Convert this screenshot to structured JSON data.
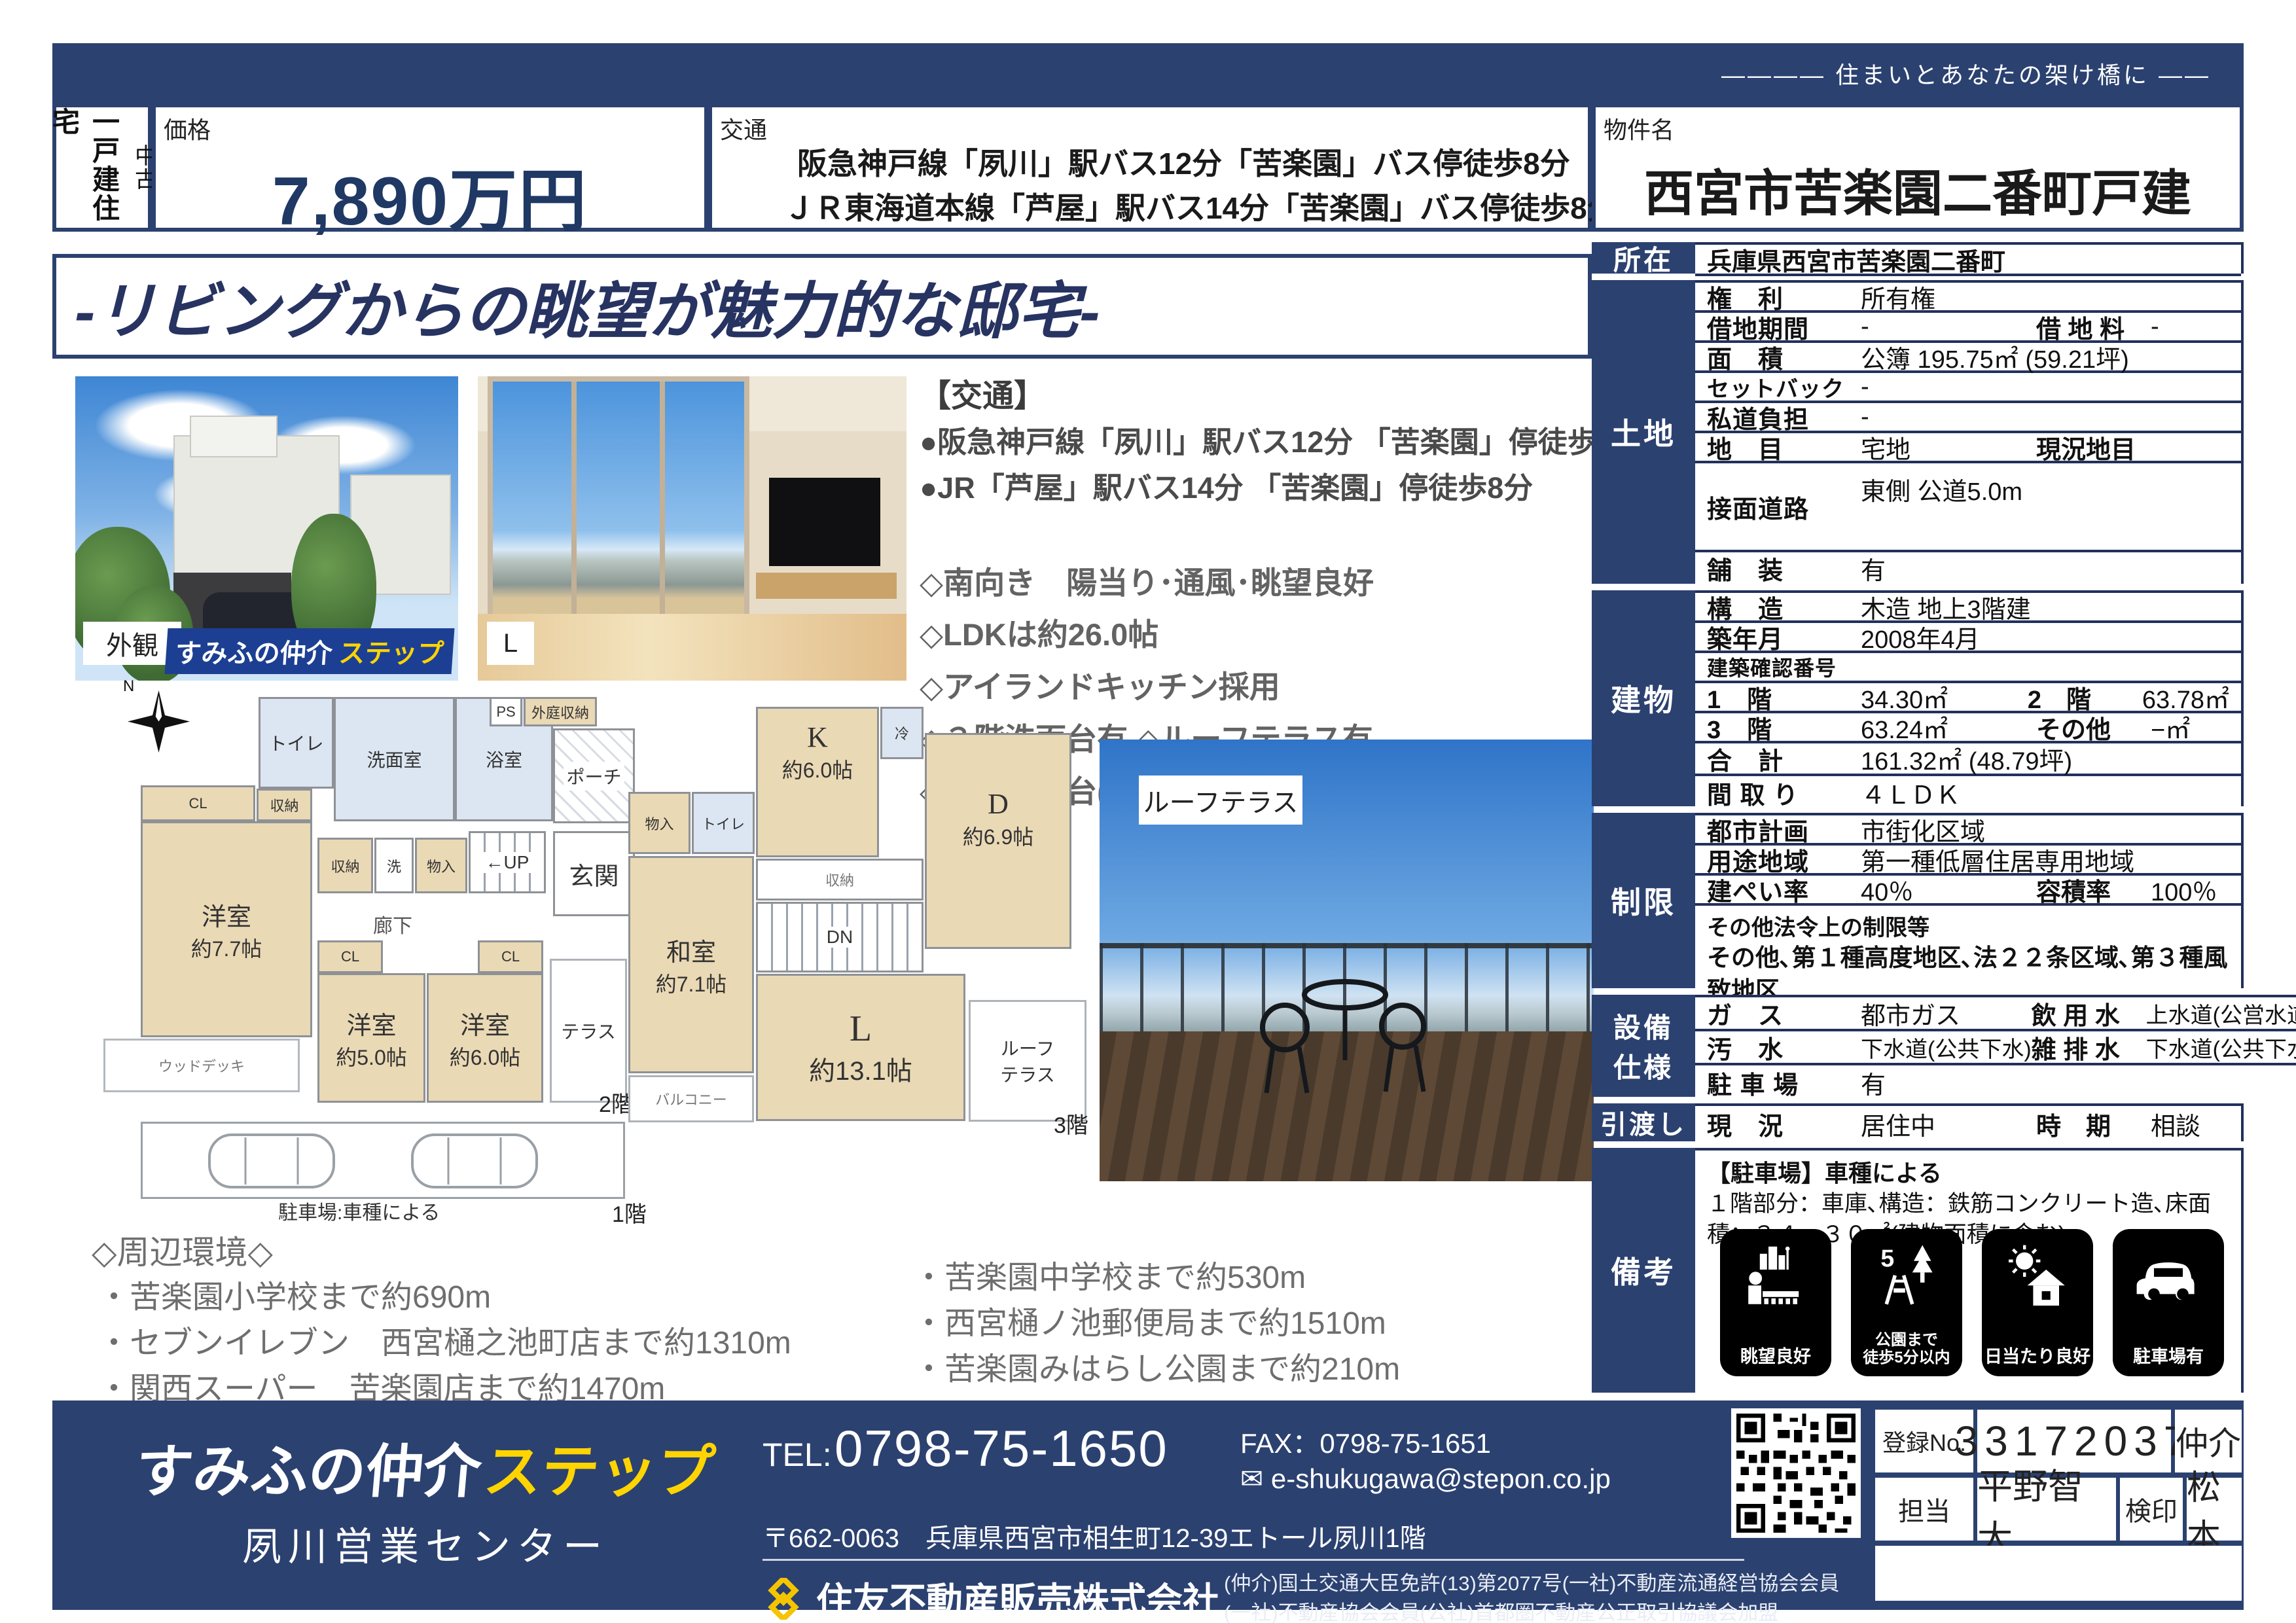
{
  "colors": {
    "navy": "#2b4170",
    "price_navy": "#1f3864",
    "yellow": "#ffd400",
    "beige": "#ead9b5",
    "wet": "#dce6f2"
  },
  "tagline": "―――― 住まいとあなたの架け橋に ――",
  "header": {
    "category_main": "一戸建住宅",
    "category_sub": "中古",
    "price_label": "価格",
    "price_value": "7,890万円",
    "access_label": "交通",
    "access_line1": "阪急神戸線「夙川」駅バス12分「苦楽園」バス停徒歩8分",
    "access_line2": "ＪＲ東海道本線「芦屋」駅バス14分「苦楽園」バス停徒歩8分",
    "property_label": "物件名",
    "property_name": "西宮市苦楽園二番町戸建"
  },
  "headline": "-リビングからの眺望が魅力的な邸宅-",
  "photos": {
    "exterior_caption": "外観",
    "brand_white": "すみふの仲介",
    "brand_yellow": "ステップ",
    "living_caption": "L",
    "roof_caption": "ルーフテラス"
  },
  "features": {
    "title": "【交通】",
    "item1": "●阪急神戸線「夙川」駅バス12分 「苦楽園」停徒歩8分",
    "item2": "●JR「芦屋」駅バス14分 「苦楽園」停徒歩8分",
    "point1": "◇南向き　陽当り･通風･眺望良好",
    "point2": "◇LDKは約26.0帖",
    "point3": "◇アイランドキッチン採用",
    "point4": "◇３階洗面台有 ◇ルーフテラス有",
    "point5": "◇駐車場２台(車種によります) ◇ウッドデッキ有"
  },
  "plan2f": {
    "compass_n": "N",
    "toilet": "トイレ",
    "wash": "洗面室",
    "bath": "浴室",
    "porch": "ポーチ",
    "ps": "PS",
    "outer_storage": "外庭収納",
    "cl1": "CL",
    "st1": "収納",
    "west1": "洋室",
    "west1_size": "約7.7帖",
    "st2": "収納",
    "laundry": "洗",
    "mono": "物入",
    "up": "←UP",
    "genkan": "玄関",
    "hall": "廊下",
    "cl2": "CL",
    "cl3": "CL",
    "west2": "洋室",
    "west2_size": "約5.0帖",
    "west3": "洋室",
    "west3_size": "約6.0帖",
    "terrace": "テラス",
    "wooddeck": "ウッドデッキ",
    "floor": "2階"
  },
  "plan3f": {
    "mono": "物入",
    "toilet": "トイレ",
    "k": "K",
    "k_size": "約6.0帖",
    "rei": "冷",
    "st": "収納",
    "d": "D",
    "d_size": "約6.9帖",
    "dn": "DN",
    "washitsu": "和室",
    "washitsu_size": "約7.1帖",
    "l": "L",
    "l_size": "約13.1帖",
    "balcony": "バルコニー",
    "roof1": "ルーフ",
    "roof2": "テラス",
    "floor": "3階"
  },
  "plan1f": {
    "label": "駐車場:車種による",
    "floor": "1階"
  },
  "surroundings": {
    "title": "◇周辺環境◇",
    "left1": "・苦楽園小学校まで約690m",
    "left2": "・セブンイレブン　西宮樋之池町店まで約1310m",
    "left3": "・関西スーパー　苦楽園店まで約1470m",
    "right1": "・苦楽園中学校まで約530m",
    "right2": "・西宮樋ノ池郵便局まで約1510m",
    "right3": "・苦楽園みはらし公園まで約210m"
  },
  "table": {
    "shozai_label": "所在",
    "shozai_value": "兵庫県西宮市苦楽園二番町",
    "tochi_label": "土地",
    "tochi": [
      {
        "l": "権　利",
        "v": "所有権"
      },
      {
        "l": "借地期間",
        "v": "-",
        "l2": "借 地 料",
        "v2": "-"
      },
      {
        "l": "面　積",
        "v": "公簿 195.75㎡ (59.21坪)"
      },
      {
        "l": "セットバック",
        "v": "-"
      },
      {
        "l": "私道負担",
        "v": "-"
      },
      {
        "l": "地　目",
        "v": "宅地",
        "l2": "現況地目",
        "v2": ""
      },
      {
        "l": "接面道路",
        "v": "東側 公道5.0m"
      },
      {
        "l": "舗　装",
        "v": "有"
      }
    ],
    "tatemono_label": "建物",
    "tatemono": [
      {
        "l": "構　造",
        "v": "木造 地上3階建"
      },
      {
        "l": "築年月",
        "v": "2008年4月"
      },
      {
        "l": "建築確認番号",
        "v": ""
      },
      {
        "l": "1　階",
        "v": "34.30㎡",
        "l2": "2　階",
        "v2": "63.78㎡"
      },
      {
        "l": "3　階",
        "v": "63.24㎡",
        "l2": "その他",
        "v2": "−㎡"
      },
      {
        "l": "合　計",
        "v": "161.32㎡ (48.79坪)"
      },
      {
        "l": "間 取 り",
        "v": "４ＬＤＫ"
      }
    ],
    "seigen_label": "制限",
    "seigen": [
      {
        "l": "都市計画",
        "v": "市街化区域"
      },
      {
        "l": "用途地域",
        "v": "第一種低層住居専用地域"
      },
      {
        "l": "建ぺい率",
        "v": "40％",
        "l2": "容積率",
        "v2": "100％"
      },
      {
        "l": "その他法令上の制限等",
        "v": "その他､第１種高度地区､法２２条区域､第３種風致地区"
      }
    ],
    "setsubi_label1": "設備",
    "setsubi_label2": "仕様",
    "setsubi": [
      {
        "l": "ガ　ス",
        "v": "都市ガス",
        "l2": "飲 用 水",
        "v2": "上水道(公営水道)"
      },
      {
        "l": "汚　水",
        "v": "下水道(公共下水)",
        "l2": "雑 排 水",
        "v2": "下水道(公共下水)"
      },
      {
        "l": "駐 車 場",
        "v": "有"
      }
    ],
    "hikiwatashi_label": "引渡し",
    "hikiwatashi": [
      {
        "l": "現　況",
        "v": "居住中",
        "l2": "時　期",
        "v2": "相談"
      }
    ],
    "biko_label": "備考",
    "biko_line1": "【駐車場】車種による",
    "biko_line2": "１階部分：車庫､構造：鉄筋コンクリート造､床面積：３４．３０㎡(建物面積に含む)",
    "badges": {
      "b1": "眺望良好",
      "b2a": "公園まで",
      "b2b": "徒歩5分以内",
      "b3": "日当たり良好",
      "b4": "駐車場有"
    }
  },
  "footer": {
    "brand_white": "すみふの仲介",
    "brand_yellow": "ステップ",
    "office": "夙川営業センター",
    "tel_label": "TEL:",
    "tel": "0798-75-1650",
    "fax": "FAX：0798-75-1651",
    "mail_icon": "✉",
    "email": "e-shukugawa@stepon.co.jp",
    "address": "〒662-0063　兵庫県西宮市相生町12-39エトール夙川1階",
    "company": "住友不動産販売株式会社",
    "legal1": "(仲介)国土交通大臣免許(13)第2077号(一社)不動産流通経営協会会員",
    "legal2": "(一社)不動産協会会員(公社)首都圏不動産公正取引協議会加盟",
    "reg_label": "登録No.",
    "reg_no": "33172037",
    "chukai": "仲介",
    "tanto_label": "担当",
    "tanto": "平野智大",
    "kenin_label": "検印",
    "kenin": "松本"
  }
}
